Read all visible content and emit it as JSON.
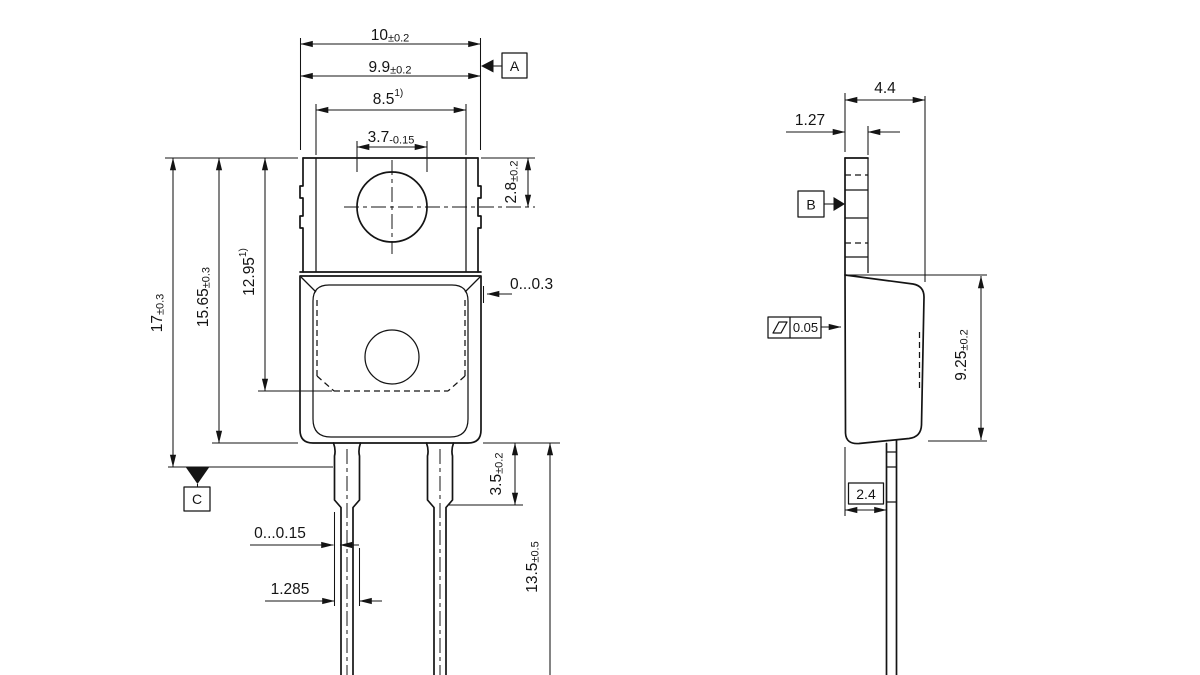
{
  "dims": {
    "d10": {
      "v": "10",
      "t": "±0.2"
    },
    "d9_9": {
      "v": "9.9",
      "t": "±0.2"
    },
    "d8_5": {
      "v": "8.5",
      "note": "1)"
    },
    "d3_7": {
      "v": "3.7",
      "t": "-0.15"
    },
    "d2_8": {
      "v": "2.8",
      "t": "±0.2"
    },
    "d17": {
      "v": "17",
      "t": "±0.3"
    },
    "d15_65": {
      "v": "15.65",
      "t": "±0.3"
    },
    "d12_95": {
      "v": "12.95",
      "note": "1)"
    },
    "gap_top": {
      "v": "0...0.3"
    },
    "d3_5": {
      "v": "3.5",
      "t": "±0.2"
    },
    "d13_5": {
      "v": "13.5",
      "t": "±0.5"
    },
    "offset": {
      "v": "0...0.15"
    },
    "d1_285": {
      "v": "1.285"
    },
    "d4_4": {
      "v": "4.4"
    },
    "d1_27": {
      "v": "1.27"
    },
    "d9_25": {
      "v": "9.25",
      "t": "±0.2"
    },
    "d2_4": {
      "v": "2.4"
    },
    "flatness": {
      "v": "0.05"
    }
  },
  "datums": {
    "a": "A",
    "b": "B",
    "c": "C"
  }
}
